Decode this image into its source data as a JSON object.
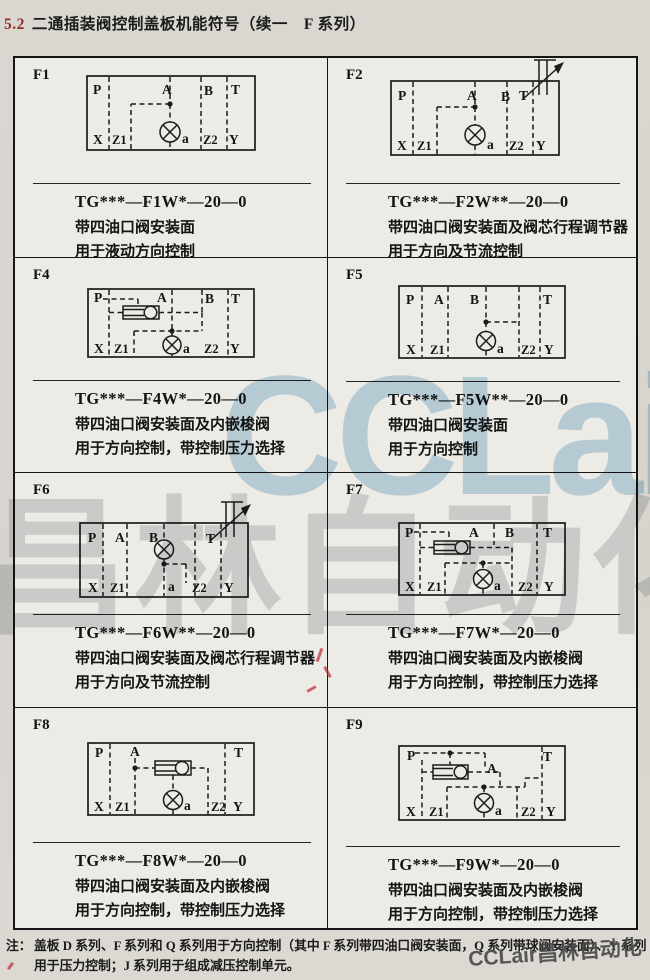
{
  "page": {
    "section_number": "5.2",
    "title": "二通插装阀控制盖板机能符号（续一　F 系列）",
    "note_label": "注：",
    "note_line1": "盖板 D 系列、F 系列和 Q 系列用于方向控制（其中 F 系列带四油口阀安装面，Q 系列带球阀安装面）、Y 系列",
    "note_line2": "用于压力控制；J 系列用于组成减压控制单元。"
  },
  "watermarks": {
    "center_text": "CCLair",
    "center_cjk": "昌林自动化",
    "corner_text": "CCLair昌林自动化",
    "blue_color": "#9cc5de",
    "gray_color": "#8a949c"
  },
  "cells": [
    {
      "id": "F1",
      "model": "TG***—F1W*—20—0",
      "desc1": "带四油口阀安装面",
      "desc2": "用于液动方向控制",
      "ports": {
        "p": "P",
        "a": "A",
        "b": "B",
        "t": "T",
        "x": "X",
        "z1": "Z1",
        "pilot": "a",
        "z2": "Z2",
        "y": "Y"
      }
    },
    {
      "id": "F2",
      "model": "TG***—F2W**—20—0",
      "desc1": "带四油口阀安装面及阀芯行程调节器",
      "desc2": "用于方向及节流控制",
      "ports": {
        "p": "P",
        "a": "A",
        "b": "B",
        "t": "T",
        "x": "X",
        "z1": "Z1",
        "pilot": "a",
        "z2": "Z2",
        "y": "Y"
      }
    },
    {
      "id": "F4",
      "model": "TG***—F4W*—20—0",
      "desc1": "带四油口阀安装面及内嵌梭阀",
      "desc2": "用于方向控制，带控制压力选择",
      "ports": {
        "p": "P",
        "a": "A",
        "b": "B",
        "t": "T",
        "x": "X",
        "z1": "Z1",
        "pilot": "a",
        "z2": "Z2",
        "y": "Y"
      }
    },
    {
      "id": "F5",
      "model": "TG***—F5W**—20—0",
      "desc1": "带四油口阀安装面",
      "desc2": "用于方向控制",
      "ports": {
        "p": "P",
        "a": "A",
        "b": "B",
        "t": "T",
        "x": "X",
        "z1": "Z1",
        "pilot": "a",
        "z2": "Z2",
        "y": "Y"
      }
    },
    {
      "id": "F6",
      "model": "TG***—F6W**—20—0",
      "desc1": "带四油口阀安装面及阀芯行程调节器",
      "desc2": "用于方向及节流控制",
      "ports": {
        "p": "P",
        "a": "A",
        "b": "B",
        "t": "T",
        "x": "X",
        "z1": "Z1",
        "pilot": "a",
        "z2": "Z2",
        "y": "Y"
      }
    },
    {
      "id": "F7",
      "model": "TG***—F7W*—20—0",
      "desc1": "带四油口阀安装面及内嵌梭阀",
      "desc2": "用于方向控制，带控制压力选择",
      "ports": {
        "p": "P",
        "a": "A",
        "b": "B",
        "t": "T",
        "x": "X",
        "z1": "Z1",
        "pilot": "a",
        "z2": "Z2",
        "y": "Y"
      }
    },
    {
      "id": "F8",
      "model": "TG***—F8W*—20—0",
      "desc1": "带四油口阀安装面及内嵌梭阀",
      "desc2": "用于方向控制，带控制压力选择",
      "ports": {
        "p": "P",
        "a": "A",
        "t": "T",
        "x": "X",
        "z1": "Z1",
        "pilot": "a",
        "z2": "Z2",
        "y": "Y"
      }
    },
    {
      "id": "F9",
      "model": "TG***—F9W*—20—0",
      "desc1": "带四油口阀安装面及内嵌梭阀",
      "desc2": "用于方向控制，带控制压力选择",
      "ports": {
        "p": "P",
        "a": "A",
        "t": "T",
        "x": "X",
        "z1": "Z1",
        "pilot": "a",
        "z2": "Z2",
        "y": "Y"
      }
    }
  ]
}
